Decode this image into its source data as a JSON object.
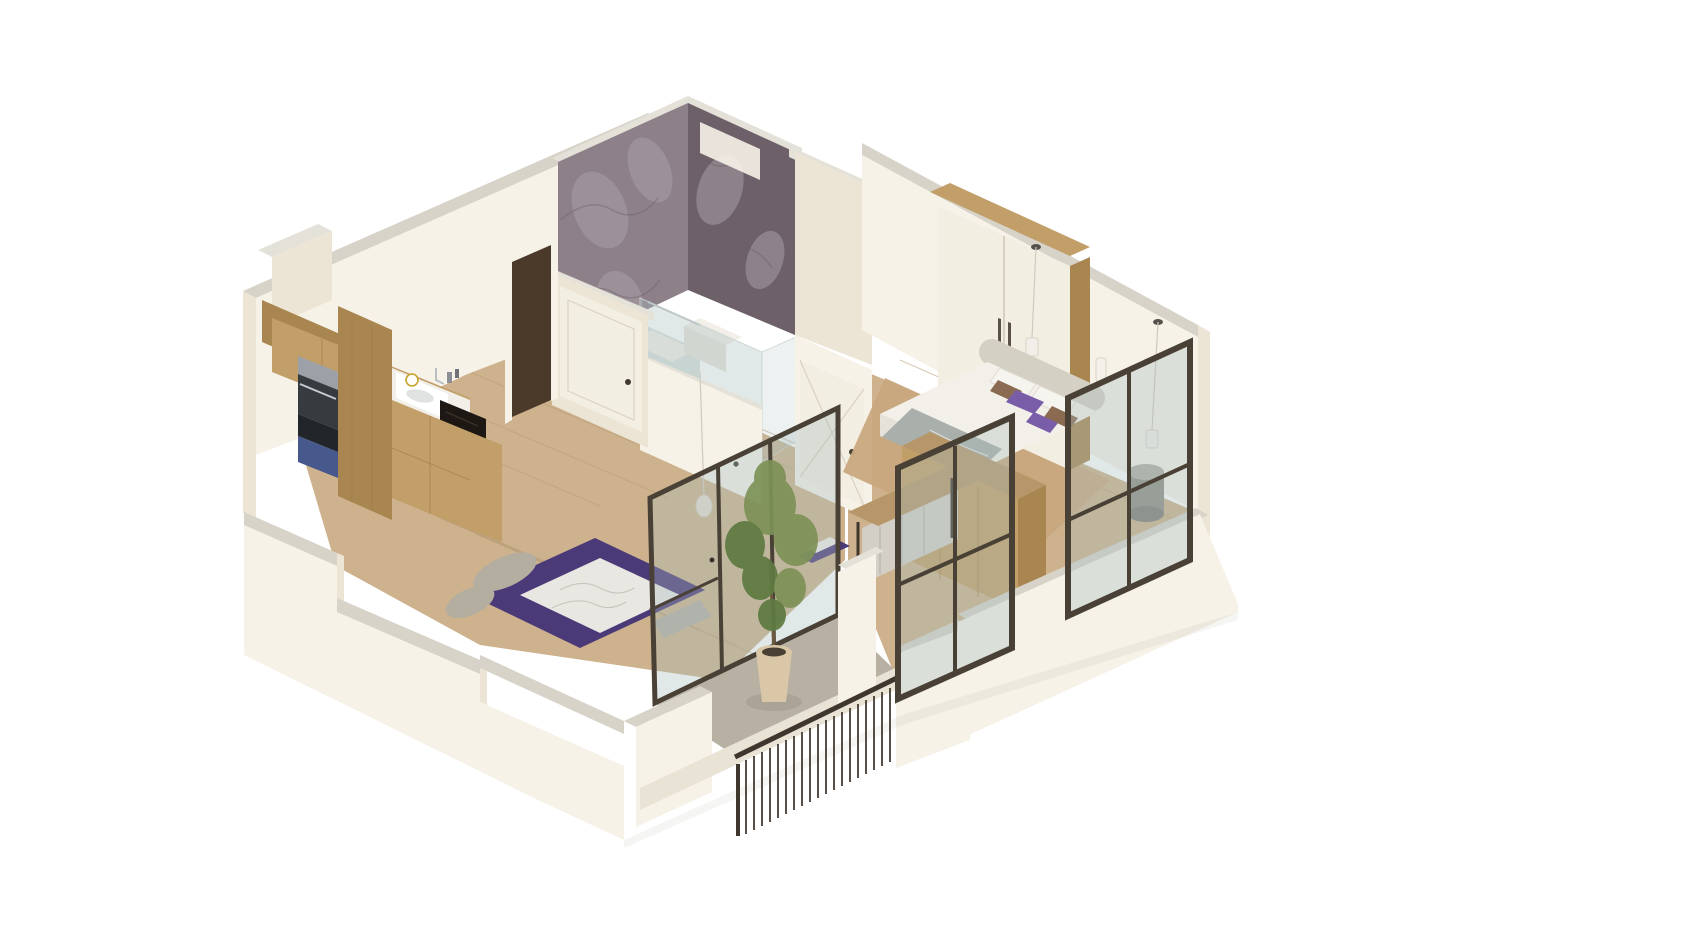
{
  "scene": {
    "kind": "isometric-3d-apartment-floor-plan-render",
    "view": "cutaway-axonometric",
    "rooms": [
      {
        "name": "kitchen-living-room",
        "features": [
          "oak-upper-cabinets",
          "oak-lower-cabinets",
          "tall-pantry-column",
          "oven-microwave-stack",
          "blue-drawer",
          "white-sink",
          "chrome-faucet",
          "black-cooktop",
          "wall-clock",
          "purple-lounge-rug",
          "marble-print-mat",
          "gray-floor-cushions",
          "wood-plank-floor"
        ]
      },
      {
        "name": "bathroom",
        "features": [
          "purple-marble-tile-walls",
          "white-panel-door",
          "glass-shower-enclosure",
          "shower-tray",
          "white-washbasin",
          "chrome-towel-rail",
          "tile-floor"
        ]
      },
      {
        "name": "hallway",
        "features": [
          "dark-entry-door",
          "white-panel-door",
          "pendant-light"
        ]
      },
      {
        "name": "bedroom",
        "features": [
          "white-wardrobe-with-oak-frame",
          "double-bed",
          "curved-headboard",
          "white-duvet",
          "purple-pillows",
          "brown-pillows",
          "gray-foot-throw",
          "oak-floor-mat",
          "wood-console-partition",
          "round-drum-side-table",
          "two-pendant-lights",
          "wall-sconce",
          "desk-with-metal-legs",
          "upholstered-bench",
          "purple-desk-cushion",
          "black-frame-windows"
        ]
      },
      {
        "name": "balcony",
        "features": [
          "dark-metal-baluster-railing",
          "potted-tree",
          "glass-sliding-doors",
          "concrete-floor",
          "white-parapet-blocks"
        ]
      }
    ]
  },
  "palette": {
    "background": "#ffffff",
    "wall_light": "#f6f2e8",
    "wall_mid": "#ece5d6",
    "wall_cap": "#d7d3c9",
    "wall_cap_light": "#e4e1d8",
    "slab": "#e9e3d6",
    "floor_wood": "#cdb28d",
    "floor_plank": "#b89e78",
    "balcony_floor": "#b7b0a3",
    "bathroom_floor": "#ccd5d1",
    "marble_light": "#a89da5",
    "marble_base": "#8e8089",
    "marble_dark": "#6d6068",
    "cabinet_wood": "#c29e68",
    "cabinet_wood_dark": "#a9854f",
    "counter_white": "#f2efe8",
    "cooktop_black": "#1d1813",
    "stainless": "#9ba1a7",
    "stainless_dark": "#363b40",
    "appliance_blue": "#46588c",
    "door_white": "#f3eee2",
    "door_dark": "#4b3a2a",
    "frame_dark": "#4a4136",
    "glass_tint": "rgba(168,190,188,0.35)",
    "glass_edge": "#c9d4d0",
    "sofa_purple": "#4b3a78",
    "throw_marble": "#e9e7e2",
    "cushion_gray": "#b4aea1",
    "bed_white": "#f3f0e9",
    "headboard_gray": "#d5d0c4",
    "pillow_purple": "#7a5da8",
    "pillow_brown": "#8a6b52",
    "blanket_gray": "#a9afaa",
    "rug_tan": "#c9a87e",
    "desk_wood": "#b79769",
    "drum_gray": "#8f8e85",
    "plant_green": "#7d9257",
    "plant_green_dark": "#5e7a41",
    "pot_beige": "#d9c7a8",
    "chrome": "#b9bec3",
    "shadow": "rgba(60,50,40,0.10)"
  }
}
